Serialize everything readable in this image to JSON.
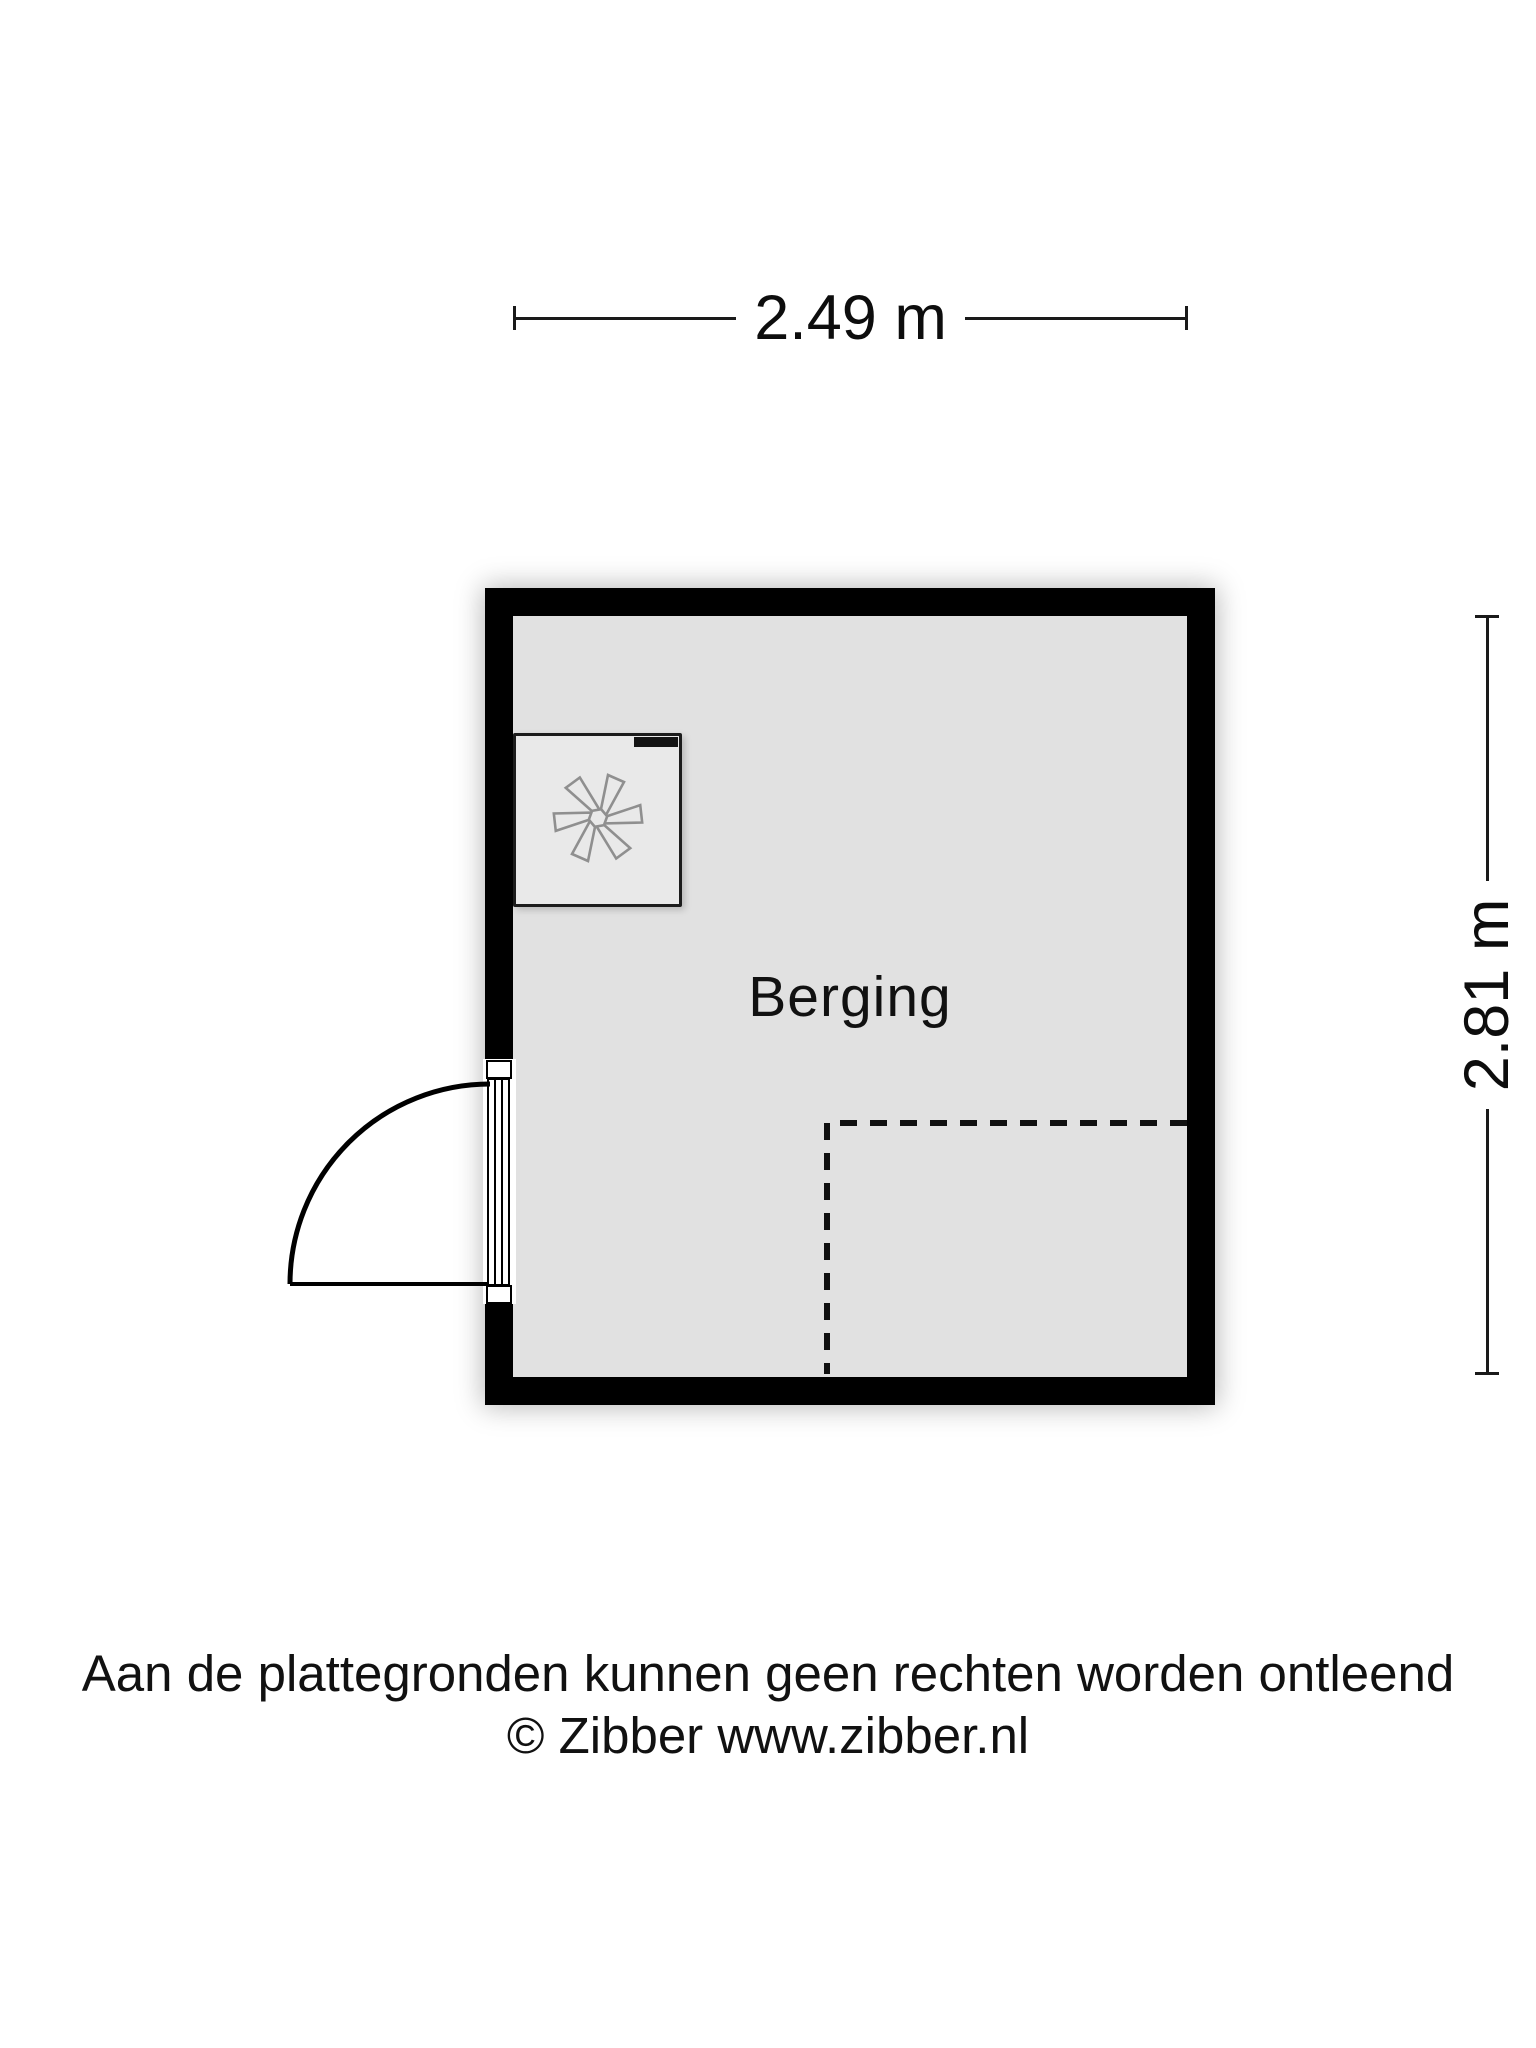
{
  "room": {
    "label": "Berging"
  },
  "dimensions": {
    "width_label": "2.49 m",
    "height_label": "2.81 m"
  },
  "footer": {
    "disclaimer": "Aan de plattegronden kunnen geen rechten worden ontleend",
    "copyright": "© Zibber www.zibber.nl"
  },
  "icons": {
    "fan": "ventilation-fan-icon",
    "door": "door-swing-arc"
  },
  "colors": {
    "wall": "#000000",
    "floor": "#e1e1e1",
    "unit": "#e9e9e9",
    "fan": "#8f8f8f",
    "ink": "#111111"
  }
}
